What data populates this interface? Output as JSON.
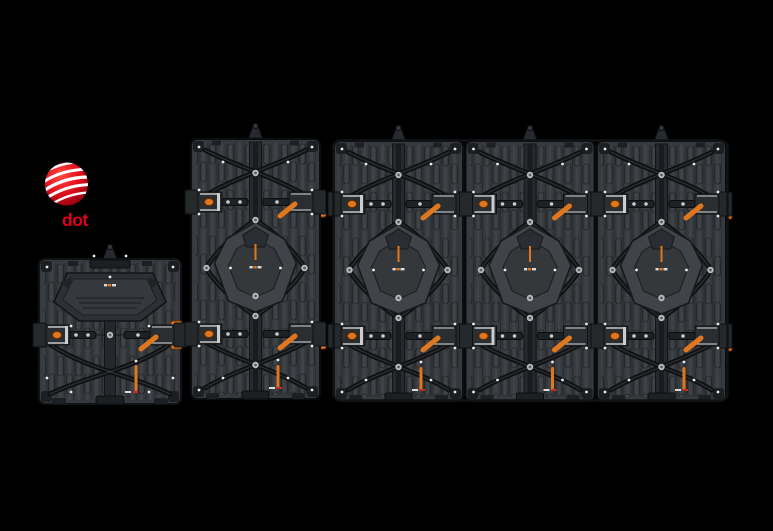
{
  "award": {
    "label": "dot"
  },
  "colors": {
    "background": "#000000",
    "brand_red": "#e2001a",
    "accent": "#e0771f",
    "panel_base": "#36393d",
    "panel_frame": "#101214",
    "hub": "#404448",
    "hub_inner": "#34383b",
    "brace": "#101113",
    "metal": "#b9bcbf",
    "screw": "#e6e8e9"
  },
  "icons": {
    "reddot-sphere-icon": "red sphere with white spiral stripes",
    "lifting-lug-icon": "conical rigging lug on cabinet top",
    "shackle-icon": "steel U-shackle hanging from lug",
    "latch-knob-icon": "orange cam-lock knob on left edge",
    "lock-lever-icon": "orange locking lever on right edge",
    "edge-tab-icon": "orange edge connector tab",
    "hub-plate-icon": "central diamond hub plate with orange slot",
    "brand-mark-icon": "tiny manufacturer mark on hub",
    "screw-icon": "white screw dot",
    "rosette-icon": "silver bolt rosette"
  },
  "panels": [
    {
      "id": "cabinet-small",
      "columns": 1
    },
    {
      "id": "cabinet-medium",
      "columns": 1
    },
    {
      "id": "cabinet-large",
      "columns": 3
    }
  ]
}
